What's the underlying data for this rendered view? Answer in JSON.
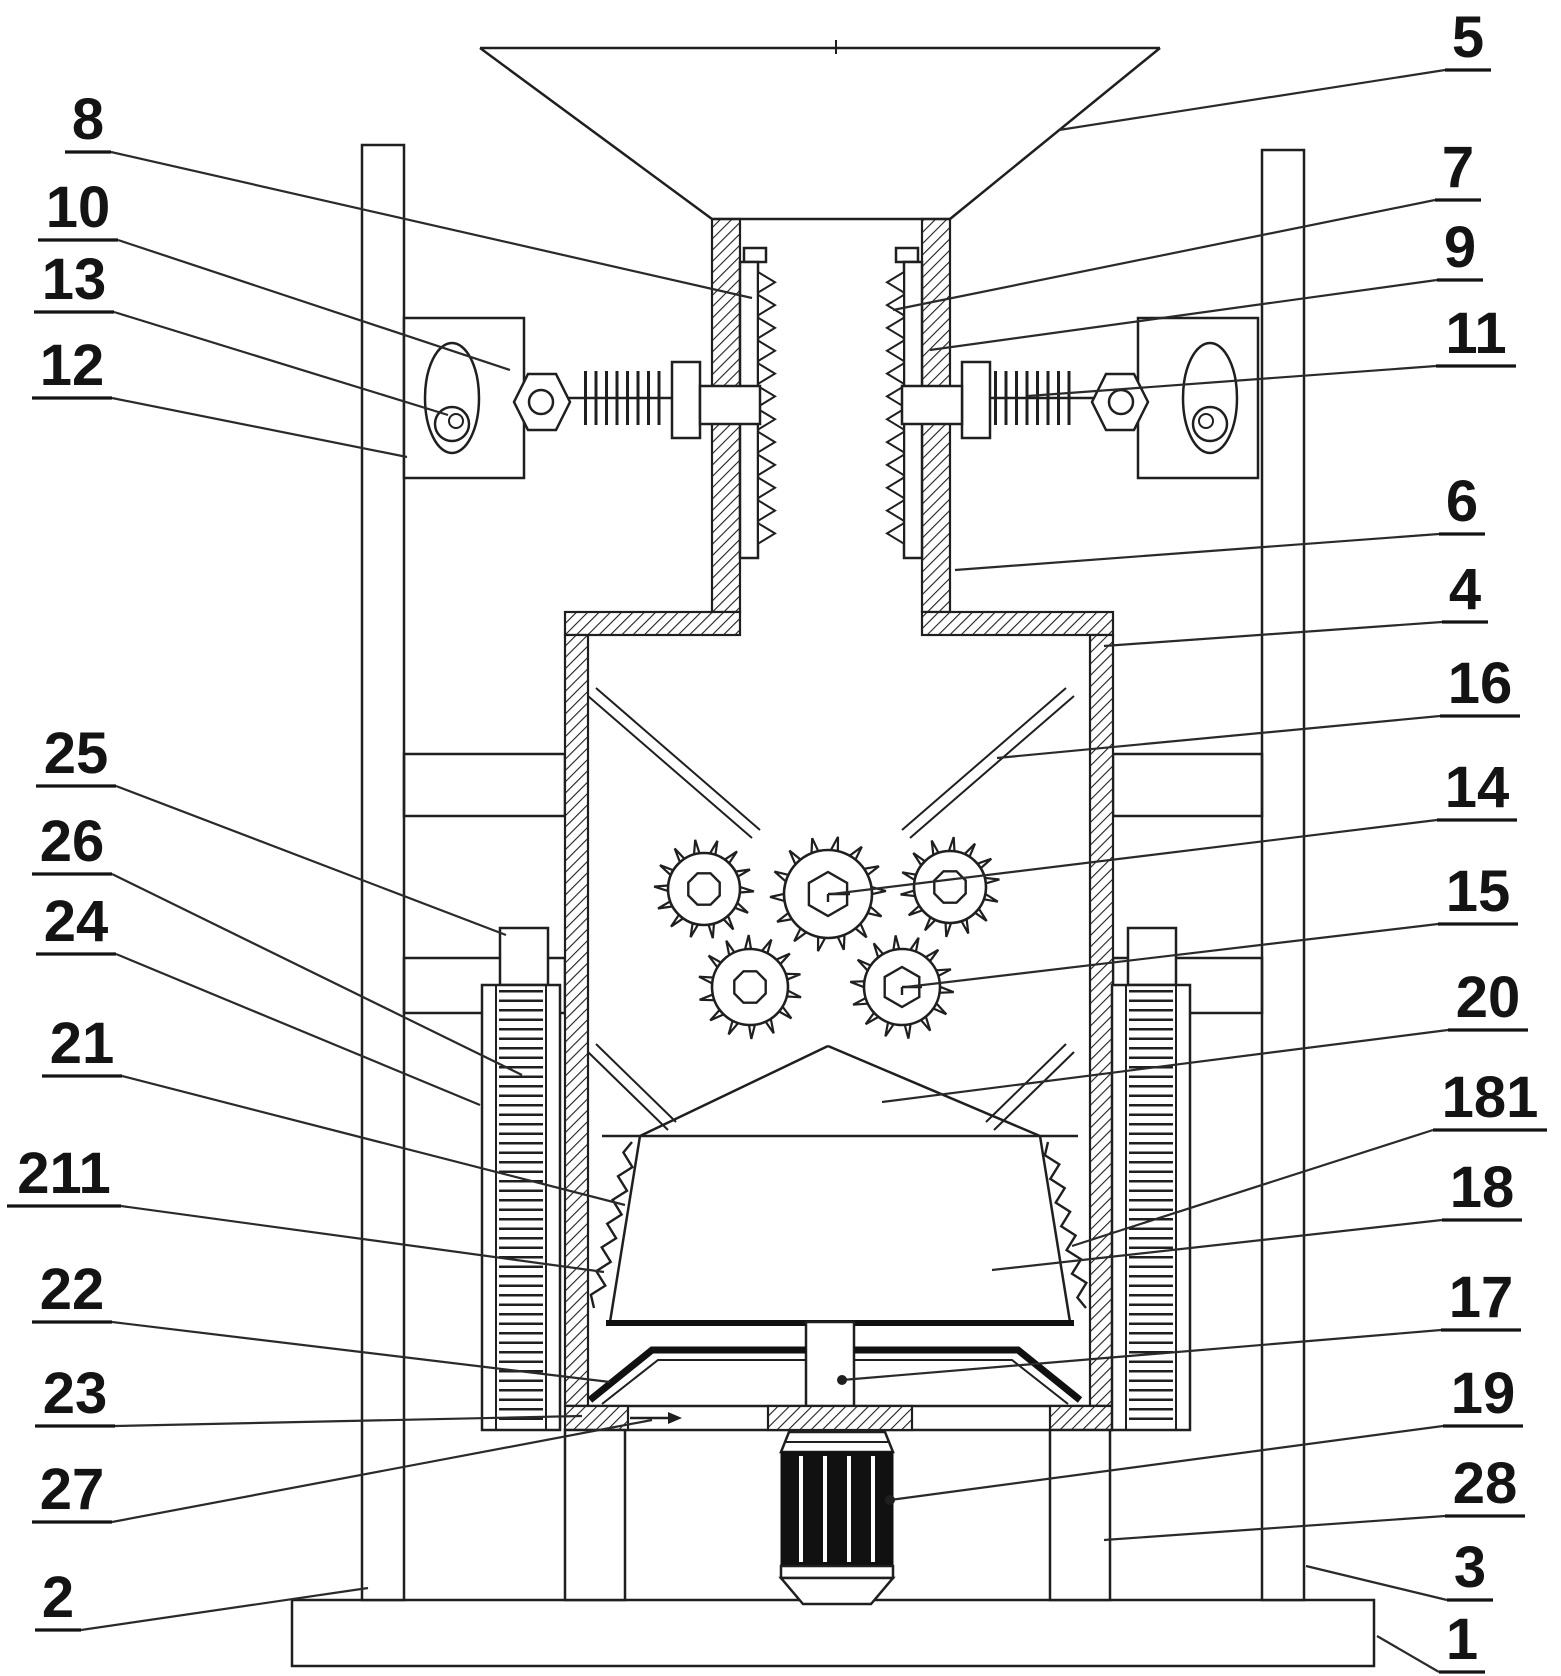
{
  "figure": {
    "kind": "patent-technical-drawing",
    "description": "Cross-section of a vertical crushing machine with feed hopper, serrated pre-crushing chute, spring adjusters, toothed crusher rollers, collection container and drive motor",
    "background_color": "#ffffff",
    "line_color": "#1f1f1f",
    "width": 1561,
    "height": 1676
  },
  "labels": [
    {
      "id": "8",
      "text": "8",
      "x": 88,
      "y": 118,
      "side": "left",
      "target": [
        752,
        298
      ],
      "dot": false
    },
    {
      "id": "10",
      "text": "10",
      "x": 78,
      "y": 206,
      "side": "left",
      "target": [
        510,
        370
      ],
      "dot": false
    },
    {
      "id": "13",
      "text": "13",
      "x": 74,
      "y": 278,
      "side": "left",
      "target": [
        448,
        415
      ],
      "dot": false
    },
    {
      "id": "12",
      "text": "12",
      "x": 72,
      "y": 364,
      "side": "left",
      "target": [
        407,
        457
      ],
      "dot": false
    },
    {
      "id": "25",
      "text": "25",
      "x": 76,
      "y": 752,
      "side": "left",
      "target": [
        506,
        935
      ],
      "dot": false
    },
    {
      "id": "26",
      "text": "26",
      "x": 72,
      "y": 840,
      "side": "left",
      "target": [
        522,
        1075
      ],
      "dot": false
    },
    {
      "id": "24",
      "text": "24",
      "x": 76,
      "y": 920,
      "side": "left",
      "target": [
        480,
        1105
      ],
      "dot": false
    },
    {
      "id": "21",
      "text": "21",
      "x": 82,
      "y": 1042,
      "side": "left",
      "target": [
        625,
        1205
      ],
      "dot": false
    },
    {
      "id": "211",
      "text": "211",
      "x": 64,
      "y": 1172,
      "side": "left",
      "target": [
        604,
        1272
      ],
      "dot": false
    },
    {
      "id": "22",
      "text": "22",
      "x": 72,
      "y": 1288,
      "side": "left",
      "target": [
        610,
        1382
      ],
      "dot": false
    },
    {
      "id": "23",
      "text": "23",
      "x": 75,
      "y": 1392,
      "side": "left",
      "target": [
        582,
        1416
      ],
      "dot": false
    },
    {
      "id": "27",
      "text": "27",
      "x": 72,
      "y": 1488,
      "side": "left",
      "target": [
        652,
        1420
      ],
      "dot": false
    },
    {
      "id": "2",
      "text": "2",
      "x": 58,
      "y": 1596,
      "side": "left",
      "target": [
        368,
        1588
      ],
      "dot": false
    },
    {
      "id": "5",
      "text": "5",
      "x": 1468,
      "y": 36,
      "side": "right",
      "target": [
        1059,
        130
      ],
      "dot": false
    },
    {
      "id": "7",
      "text": "7",
      "x": 1458,
      "y": 166,
      "side": "right",
      "target": [
        893,
        310
      ],
      "dot": false
    },
    {
      "id": "9",
      "text": "9",
      "x": 1460,
      "y": 246,
      "side": "right",
      "target": [
        930,
        350
      ],
      "dot": false
    },
    {
      "id": "11",
      "text": "11",
      "x": 1476,
      "y": 332,
      "side": "right",
      "target": [
        1028,
        396
      ],
      "dot": false
    },
    {
      "id": "6",
      "text": "6",
      "x": 1462,
      "y": 500,
      "side": "right",
      "target": [
        955,
        570
      ],
      "dot": false
    },
    {
      "id": "4",
      "text": "4",
      "x": 1465,
      "y": 588,
      "side": "right",
      "target": [
        1104,
        646
      ],
      "dot": false
    },
    {
      "id": "16",
      "text": "16",
      "x": 1480,
      "y": 682,
      "side": "right",
      "target": [
        997,
        758
      ],
      "dot": false
    },
    {
      "id": "14",
      "text": "14",
      "x": 1477,
      "y": 786,
      "side": "right",
      "target": [
        832,
        894
      ],
      "dot": false
    },
    {
      "id": "15",
      "text": "15",
      "x": 1478,
      "y": 890,
      "side": "right",
      "target": [
        906,
        987
      ],
      "dot": false
    },
    {
      "id": "20",
      "text": "20",
      "x": 1488,
      "y": 996,
      "side": "right",
      "target": [
        882,
        1102
      ],
      "dot": false
    },
    {
      "id": "181",
      "text": "181",
      "x": 1490,
      "y": 1096,
      "side": "right",
      "target": [
        1072,
        1246
      ],
      "dot": false
    },
    {
      "id": "18",
      "text": "18",
      "x": 1482,
      "y": 1186,
      "side": "right",
      "target": [
        992,
        1270
      ],
      "dot": false
    },
    {
      "id": "17",
      "text": "17",
      "x": 1481,
      "y": 1296,
      "side": "right",
      "target": [
        842,
        1380
      ],
      "dot": true
    },
    {
      "id": "19",
      "text": "19",
      "x": 1483,
      "y": 1392,
      "side": "right",
      "target": [
        890,
        1500
      ],
      "dot": true
    },
    {
      "id": "28",
      "text": "28",
      "x": 1485,
      "y": 1482,
      "side": "right",
      "target": [
        1104,
        1540
      ],
      "dot": false
    },
    {
      "id": "3",
      "text": "3",
      "x": 1470,
      "y": 1566,
      "side": "right",
      "target": [
        1306,
        1566
      ],
      "dot": false
    },
    {
      "id": "1",
      "text": "1",
      "x": 1462,
      "y": 1638,
      "side": "right",
      "target": [
        1377,
        1636
      ],
      "dot": false
    }
  ],
  "gears": [
    {
      "cx": 704,
      "cy": 889,
      "rbody": 36,
      "rteeth": 50,
      "teeth": 14,
      "inner": "oct",
      "ri": 17
    },
    {
      "cx": 828,
      "cy": 894,
      "rbody": 44,
      "rteeth": 58,
      "teeth": 14,
      "inner": "hexline",
      "ri": 22
    },
    {
      "cx": 950,
      "cy": 887,
      "rbody": 36,
      "rteeth": 50,
      "teeth": 14,
      "inner": "oct",
      "ri": 17
    },
    {
      "cx": 750,
      "cy": 987,
      "rbody": 38,
      "rteeth": 52,
      "teeth": 14,
      "inner": "oct",
      "ri": 17
    },
    {
      "cx": 902,
      "cy": 987,
      "rbody": 38,
      "rteeth": 52,
      "teeth": 14,
      "inner": "hexline",
      "ri": 20
    }
  ],
  "serrated_plates": [
    {
      "x": 758,
      "dir": 1,
      "y0": 272,
      "y1": 546,
      "n": 12,
      "depth": 17
    },
    {
      "x": 904,
      "dir": -1,
      "y0": 272,
      "y1": 546,
      "n": 12,
      "depth": 17
    }
  ],
  "zigzag_strips": [
    {
      "x1": 632,
      "y1": 1142,
      "x2": 594,
      "y2": 1308,
      "segments": 14,
      "amp": 6
    },
    {
      "x1": 1048,
      "y1": 1142,
      "x2": 1086,
      "y2": 1308,
      "segments": 14,
      "amp": 6
    }
  ],
  "discharge_arrow": {
    "x1": 630,
    "y1": 1418,
    "x2": 668,
    "y2": 1418
  }
}
